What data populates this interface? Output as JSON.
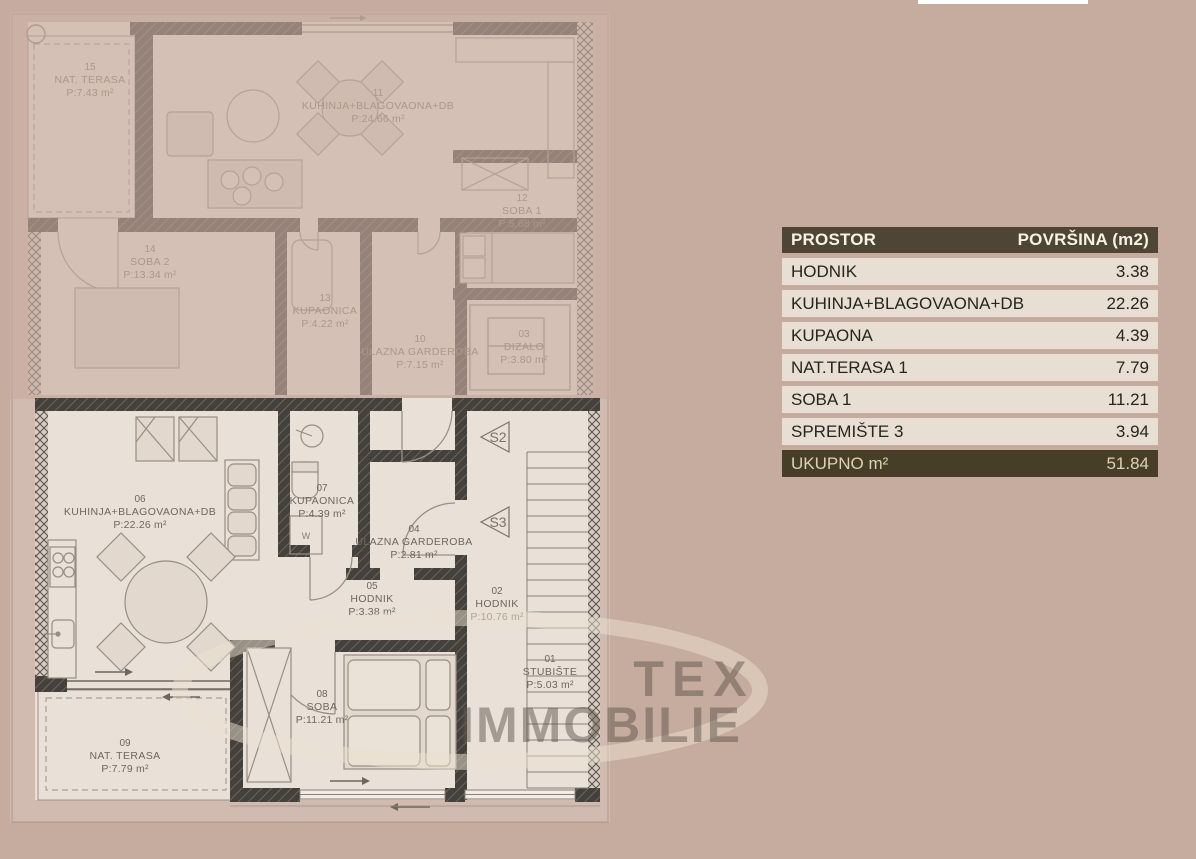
{
  "colors": {
    "background": "#c6ab9f",
    "floor": "#e9e1d8",
    "wall_dark": "#44403b",
    "table_header_bg": "#4e4536",
    "table_header_text": "#f7f1e2",
    "table_row_bg": "#e7dfd3",
    "table_row_text": "#26241f",
    "table_total_bg": "#463e26",
    "table_total_text": "#ddd2b2"
  },
  "watermark": {
    "line1": "TEX",
    "line2": "IMMOBILIE"
  },
  "area_table": {
    "header": {
      "space": "PROSTOR",
      "area": "POVRŠINA (m2)"
    },
    "rows": [
      {
        "space": "HODNIK",
        "area": "3.38"
      },
      {
        "space": "KUHINJA+BLAGOVAONA+DB",
        "area": "22.26"
      },
      {
        "space": "KUPAONA",
        "area": "4.39"
      },
      {
        "space": "NAT.TERASA 1",
        "area": "7.79"
      },
      {
        "space": "SOBA 1",
        "area": "11.21"
      },
      {
        "space": "SPREMIŠTE 3",
        "area": "3.94"
      }
    ],
    "total": {
      "space": "UKUPNO m²",
      "area": "51.84"
    }
  },
  "floor_plan": {
    "upper_faded_rooms": [
      {
        "id": "15",
        "name": "NAT. TERASA",
        "area": "P:7.43 m²"
      },
      {
        "id": "11",
        "name": "KUHINJA+BLAGOVAONA+DB",
        "area": "P:24.66 m²"
      },
      {
        "id": "12",
        "name": "SOBA 1",
        "area": "P:5.68 m²"
      },
      {
        "id": "14",
        "name": "SOBA 2",
        "area": "P:13.34 m²"
      },
      {
        "id": "13",
        "name": "KUPAONICA",
        "area": "P:4.22 m²"
      },
      {
        "id": "10",
        "name": "ULAZNA GARDEROBA",
        "area": "P:7.15 m²"
      },
      {
        "id": "03",
        "name": "DIZALO",
        "area": "P:3.80 m²"
      }
    ],
    "lower_rooms": [
      {
        "id": "06",
        "name": "KUHINJA+BLAGOVAONA+DB",
        "area": "P:22.26 m²"
      },
      {
        "id": "07",
        "name": "KUPAONICA",
        "area": "P:4.39 m²"
      },
      {
        "id": "04",
        "name": "ULAZNA GARDEROBA",
        "area": "P:2.81 m²"
      },
      {
        "id": "05",
        "name": "HODNIK",
        "area": "P:3.38 m²"
      },
      {
        "id": "02",
        "name": "HODNIK",
        "area": "P:10.76 m²"
      },
      {
        "id": "01",
        "name": "STUBIŠTE",
        "area": "P:5.03 m²"
      },
      {
        "id": "08",
        "name": "SOBA",
        "area": "P:11.21 m²"
      },
      {
        "id": "09",
        "name": "NAT. TERASA",
        "area": "P:7.79 m²"
      }
    ],
    "stair_markers": [
      "S2",
      "S3"
    ],
    "washer_label": "W"
  }
}
